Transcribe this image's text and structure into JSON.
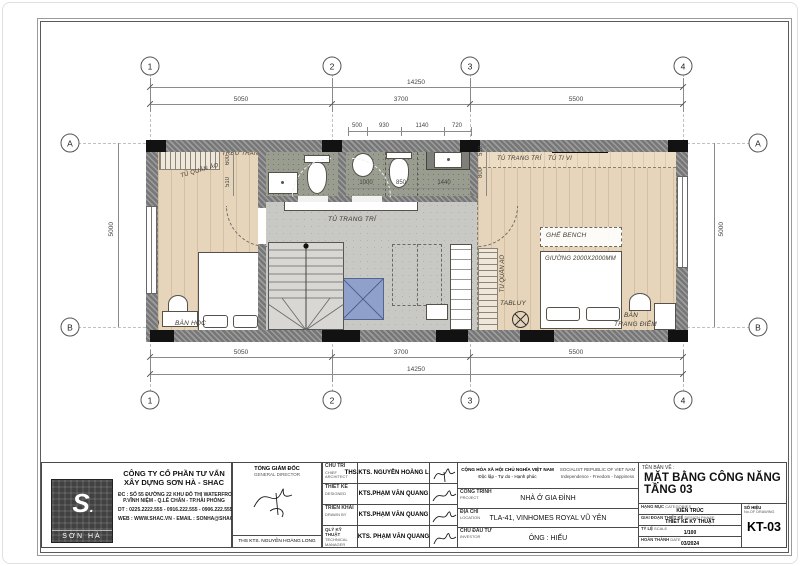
{
  "sheet": {
    "grid": {
      "cols": [
        "1",
        "2",
        "3",
        "4"
      ],
      "rows": [
        "A",
        "B"
      ]
    },
    "dims": {
      "overall": "14250",
      "segs": [
        "5050",
        "3700",
        "5500"
      ],
      "side": "5000",
      "bath_top": [
        "500",
        "930",
        "1140",
        "720"
      ],
      "bath_bottom": [
        "1000",
        "850",
        "1440"
      ],
      "left_chain": [
        "600",
        "510"
      ],
      "right_chain": [
        "510",
        "800"
      ]
    },
    "labels": {
      "treo_tranh": "TREO TRANH",
      "tu_quan_ao": "TỦ QUẦN ÁO",
      "tu_trang_tri": "TỦ TRANG TRÍ",
      "tu_tivi": "TỦ TI VI",
      "ghe_bench": "GHẾ BENCH",
      "giuong": "GIƯỜNG 2000X2000MM",
      "tabluy": "TABLUY",
      "ban": "BÀN",
      "trang_diem": "TRANG ĐIỂM",
      "ban_hoc": "BÀN HỌC"
    }
  },
  "titleblock": {
    "company": {
      "logo": "SƠN HÀ",
      "name1": "CÔNG TY CỔ PHẦN TƯ VẤN",
      "name2": "XÂY DỰNG SƠN HÀ - SHAC",
      "addr1": "ĐC : SỐ 55 ĐƯỜNG 22 KHU ĐÔ THỊ WATERFRONT",
      "addr2": "P.VĨNH NIỆM - Q.LÊ CHÂN - TP.HẢI PHÒNG",
      "tel": "DT : 0225.2222.555 - 0916.222.555 - 0906.222.555",
      "web": "WEB : WWW.SHAC.VN - EMAIL : SONHA@SHAC.VN"
    },
    "director": {
      "title_vn": "TỔNG GIÁM ĐỐC",
      "title_en": "GENERAL DIRECTOR",
      "name": "THS KTS. NGUYỄN HOÀNG LONG"
    },
    "staff": [
      {
        "role_vn": "CHỦ TRÌ",
        "role_en": "CHIEF ARCHITECT",
        "name": "THS.KTS. NGUYỄN HOÀNG LONG"
      },
      {
        "role_vn": "THIẾT KẾ",
        "role_en": "DESIGNED",
        "name": "KTS.PHẠM VĂN QUANG"
      },
      {
        "role_vn": "TRIỂN KHAI",
        "role_en": "DRAWN BY",
        "name": "KTS.PHẠM VĂN QUANG"
      },
      {
        "role_vn": "QLÝ KỸ THUẬT",
        "role_en": "TECHNICAL MANAGER",
        "name": "KTS. PHẠM VĂN QUANG"
      }
    ],
    "republic": {
      "vn1": "CỘNG HÒA XÃ HỘI CHỦ NGHĨA VIỆT NAM",
      "vn2": "Độc lập - Tự do - Hạnh phúc",
      "en1": "SOCIALIST REPUBLIC OF VIET NAM",
      "en2": "Independence - Freedom - happiness"
    },
    "project": {
      "label_vn": "CÔNG TRÌNH",
      "label_en": "PROJECT",
      "value": "NHÀ Ở GIA ĐÌNH"
    },
    "location": {
      "label_vn": "ĐỊA CHỈ",
      "label_en": "LOCATION",
      "value": "TLA-41, VINHOMES ROYAL VŨ YÊN"
    },
    "investor": {
      "label_vn": "CHỦ ĐẦU TƯ",
      "label_en": "INVESTOR",
      "value": "ÔNG : HIẾU"
    },
    "drawing": {
      "label": "TÊN BẢN VẼ :",
      "title1": "MẶT BẰNG CÔNG NĂNG",
      "title2": "TẦNG 03"
    },
    "meta": [
      {
        "label_vn": "HẠNG MỤC",
        "label_en": "CATEGORIES",
        "value": "KIẾN TRÚC"
      },
      {
        "label_vn": "GIAI ĐOẠN THIẾT KẾ",
        "label_en": "DESIGN PHASE",
        "value": "THIẾT KẾ KỸ THUẬT"
      },
      {
        "label_vn": "TỶ LỆ",
        "label_en": "SCALE",
        "value": "1/100"
      },
      {
        "label_vn": "HOÀN THÀNH",
        "label_en": "DATE",
        "value": "03/2024"
      }
    ],
    "number": {
      "label_vn": "SỐ HIỆU",
      "label_en": "No.OF DRAWING",
      "value": "KT-03"
    }
  },
  "colors": {
    "wood": "#e6d5ba",
    "bath": "#989d8f",
    "corridor": "#c8c8c4",
    "void_blue": "#8fa0cb",
    "wall": "#777777"
  }
}
